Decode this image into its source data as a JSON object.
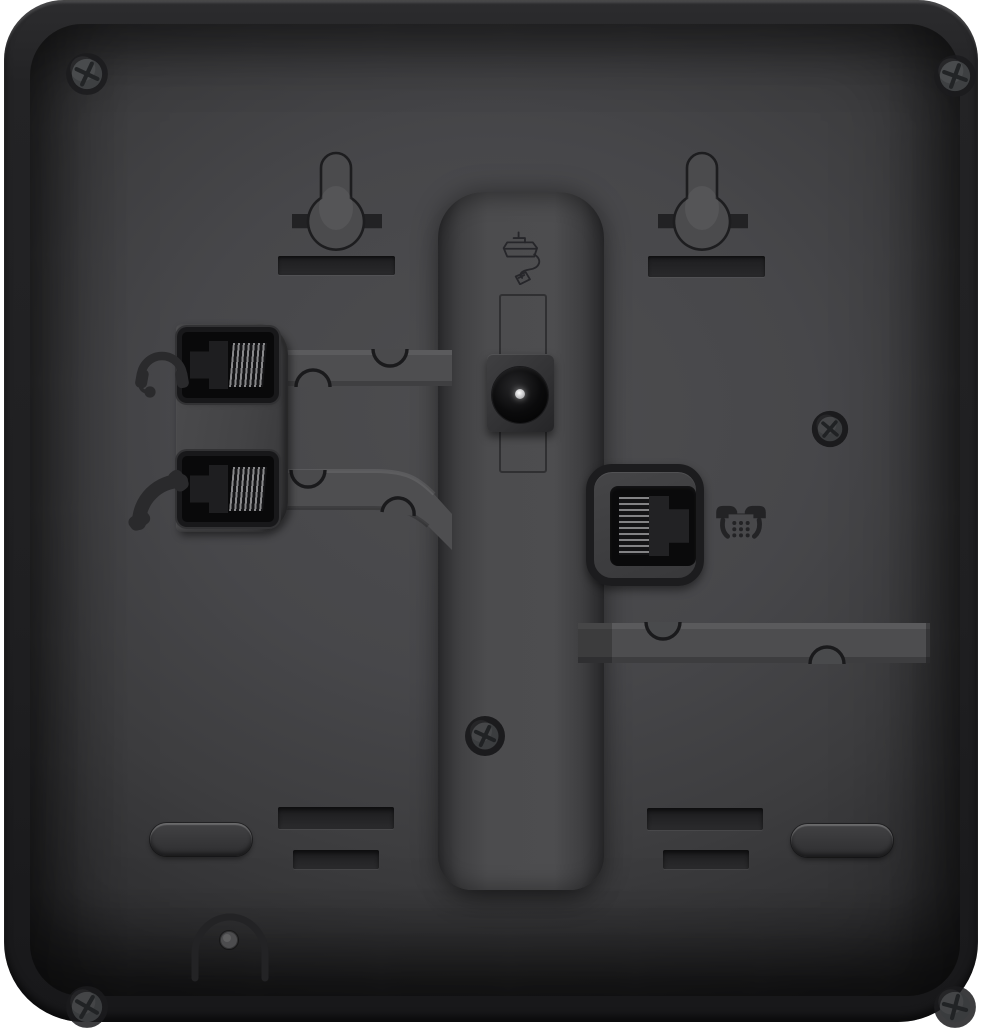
{
  "scene": {
    "description": "Rear view of a black desk telephone",
    "background": "#ffffff"
  },
  "palette": {
    "body": "#232325",
    "panel": "#47474a",
    "recess_dark": "#222224",
    "port_black": "#0a0a0b",
    "cable_channel": "#4e4e50",
    "contact_pins": "#939395",
    "power_pin_highlight": "#d8d8da",
    "engraving": "#29292b"
  },
  "parts": {
    "corner_screw": "corner screw",
    "keyhole": "wall-mount keyhole",
    "mount_slot": "wall-mount slot",
    "mount_bar": "wall-mount bar slot",
    "stand_channel": "stand channel",
    "power_icon": "power adapter icon",
    "power_recess": "power cable recess",
    "dc_jack": "DC power jack",
    "dc_pin": "DC center pin",
    "port_plate": "side port plate",
    "headset_jack": "headset jack",
    "handset_jack": "handset jack",
    "headset_icon": "headset icon",
    "handset_icon": "handset icon",
    "cable_guide": "cable routing guide",
    "line_jack": "telephone line jack",
    "phone_icon": "telephone icon",
    "screw": "screw",
    "stand_slot": "stand slot",
    "foot": "rubber foot",
    "cable_anchor": "cable anchor"
  }
}
